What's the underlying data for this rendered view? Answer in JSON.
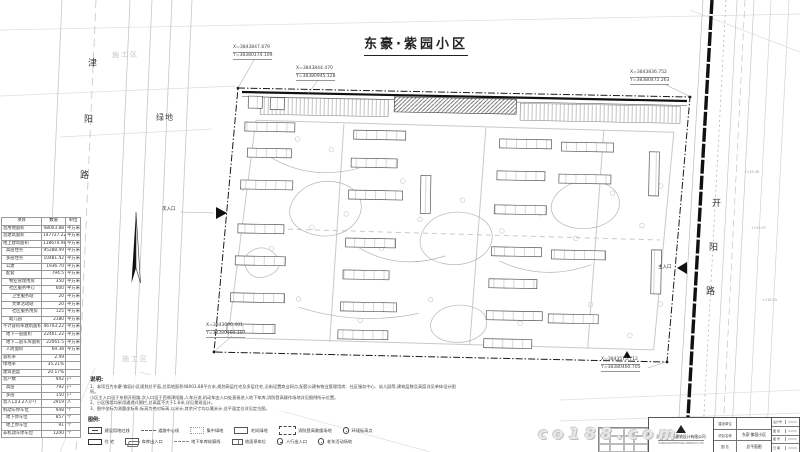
{
  "title": {
    "text": "东豪·紫园小区"
  },
  "roads": {
    "left_vertical": [
      "津",
      "阳",
      "路"
    ],
    "right_vertical": [
      "开",
      "阳",
      "路"
    ],
    "green_label": "绿地",
    "construction_zone_top": "施工区",
    "construction_zone_bottom": "施工区"
  },
  "entrances": {
    "secondary": "次入口",
    "main": "主入口"
  },
  "coordinates": {
    "top_left_a": {
      "x": "X=3843847.679",
      "y": "Y=38380174.109"
    },
    "top_left_b": {
      "x": "X=3843844.470",
      "y": "Y=38380945.128"
    },
    "top_right": {
      "x": "X=3843836.752",
      "y": "Y=38380472.263"
    },
    "bottom_left": {
      "x": "X=3843696.401",
      "y": "Y=38380160.107"
    },
    "bottom_right": {
      "x": "X=3843575.712",
      "y": "Y=38380460.705"
    }
  },
  "spot_elevations": [
    "+119.46",
    "+119.37",
    "+118.35"
  ],
  "stats_table": {
    "headers": [
      "项目",
      "数值",
      "单位"
    ],
    "rows": [
      {
        "label": "总用地面积",
        "value": "48003.88",
        "unit": "平方米",
        "level": 0
      },
      {
        "label": "总建筑面积",
        "value": "147727.22",
        "unit": "平方米",
        "level": 0
      },
      {
        "label": "地上建筑面积",
        "value": "118674.98",
        "unit": "平方米",
        "level": 0
      },
      {
        "label": "高层住宅",
        "value": "95288.49",
        "unit": "平方米",
        "level": 1
      },
      {
        "label": "多层住宅",
        "value": "10481.42",
        "unit": "平方米",
        "level": 1
      },
      {
        "label": "公建",
        "value": "1936.70",
        "unit": "平方米",
        "level": 1
      },
      {
        "label": "配套",
        "value": "794.5",
        "unit": "平方米",
        "level": 1
      },
      {
        "label": "物业管理用房",
        "value": "350",
        "unit": "平方米",
        "level": 2
      },
      {
        "label": "社区服务中心",
        "value": "600",
        "unit": "平方米",
        "level": 2
      },
      {
        "label": "卫生服务站",
        "value": "20",
        "unit": "平方米",
        "level": 3
      },
      {
        "label": "文体活动站",
        "value": "20",
        "unit": "平方米",
        "level": 3
      },
      {
        "label": "社区服务用房",
        "value": "125",
        "unit": "平方米",
        "level": 3
      },
      {
        "label": "幼儿园",
        "value": "2180",
        "unit": "平方米",
        "level": 2
      },
      {
        "label": "不计容积率建筑面积",
        "value": "46703.22",
        "unit": "平方米",
        "level": 0
      },
      {
        "label": "地下一层面积",
        "value": "22461.22",
        "unit": "平方米",
        "level": 1
      },
      {
        "label": "地下二层车库面积",
        "value": "22061.5",
        "unit": "平方米",
        "level": 1
      },
      {
        "label": "人防面积",
        "value": "69.38",
        "unit": "平方米",
        "level": 1
      },
      {
        "label": "容积率",
        "value": "2.49",
        "unit": "",
        "level": 0
      },
      {
        "label": "绿地率",
        "value": "35.21%",
        "unit": "",
        "level": 0
      },
      {
        "label": "建筑密度",
        "value": "20.17%",
        "unit": "",
        "level": 0
      },
      {
        "label": "总户数",
        "value": "942",
        "unit": "户",
        "level": 0
      },
      {
        "label": "高层",
        "value": "792",
        "unit": "户",
        "level": 1
      },
      {
        "label": "多层",
        "value": "150",
        "unit": "户",
        "level": 1
      },
      {
        "label": "总人口(3.2人/户)",
        "value": "2919",
        "unit": "人",
        "level": 0
      },
      {
        "label": "机动车停车位",
        "value": "948",
        "unit": "个",
        "level": 0
      },
      {
        "label": "地下停车位",
        "value": "857",
        "unit": "个",
        "level": 1
      },
      {
        "label": "地上停车位",
        "value": "91",
        "unit": "个",
        "level": 1
      },
      {
        "label": "非机动车停车位",
        "value": "1200",
        "unit": "个",
        "level": 0
      }
    ]
  },
  "notes": {
    "heading": "说明:",
    "lines": [
      "1、本项目为东豪·紫园小区规划总平面,总用地面积48003.88平方米,规划高层住宅及多层住宅,沿街设置商业网点,配套公建有物业管理用房、社区服务中心、幼儿园等,建筑层数及高度详见单体设计图纸。",
      "    小区主入口设于东侧开阳路,次入口设于西侧津阳路,人车分流,机动车由入口处直接进入地下车库,消防登高操作场地详见图例所示位置。",
      "2、小区围墙均采用通透式围栏,总高度不大于1.8米,详见景观设计。",
      "3、图中坐标为测量坐标系,标高为绝对标高,以米计,其余尺寸均以毫米计,总平面定位详见定位图。"
    ]
  },
  "legend": {
    "heading": "图例:",
    "row1": [
      {
        "sym": "s-redline",
        "icon": "boundary-redline-symbol",
        "label": "建设用地红线"
      },
      {
        "sym": "s-centerline",
        "icon": "road-centerline-symbol",
        "label": "道路中心线"
      },
      {
        "sym": "s-greendot",
        "icon": "central-green-symbol",
        "label": "集中绿地"
      },
      {
        "sym": "s-box",
        "icon": "courtyard-green-symbol",
        "label": "宅间绿地"
      },
      {
        "sym": "s-dashdot",
        "icon": "fire-rescue-site-symbol",
        "label": "消防登高救援场地"
      },
      {
        "sym": "s-circle",
        "icon": "elevation-point-symbol",
        "label": "环境标高点"
      }
    ],
    "row2": [
      {
        "sym": "s-solidbox",
        "icon": "residence-symbol",
        "label": "住  宅"
      },
      {
        "sym": "s-garage",
        "icon": "garage-entrance-symbol",
        "label": "车库出入口"
      },
      {
        "sym": "s-dash",
        "icon": "basement-outline-symbol",
        "label": "地下车库轮廓线"
      },
      {
        "sym": "s-parking",
        "icon": "surface-parking-symbol",
        "label": "地面停车位"
      },
      {
        "sym": "s-circle",
        "icon": "pedestrian-entry-symbol",
        "label": "人行出入口"
      },
      {
        "sym": "s-circle",
        "icon": "elderly-activity-symbol",
        "label": "老年活动场地"
      }
    ]
  },
  "title_block": {
    "company": "湖南省广电建筑设计有限公司",
    "company_en": "HUNAN ARCHITECTURAL DESIGN CO.,LTD",
    "fields": [
      {
        "label": "建设单位",
        "value": ""
      },
      {
        "label": "项目名称",
        "value": "东豪·紫园小区"
      },
      {
        "label": "图  名",
        "value": "总平面图"
      }
    ],
    "side_labels": [
      "设计号",
      "图 别",
      "图 号",
      "日 期"
    ]
  },
  "watermark": {
    "text": "co188.com"
  },
  "colors": {
    "line_dark": "#1a1a1a",
    "line_mid": "#555555",
    "line_light": "#c8c8c8",
    "text_faint": "#c6c6c6",
    "paper": "#ffffff"
  }
}
